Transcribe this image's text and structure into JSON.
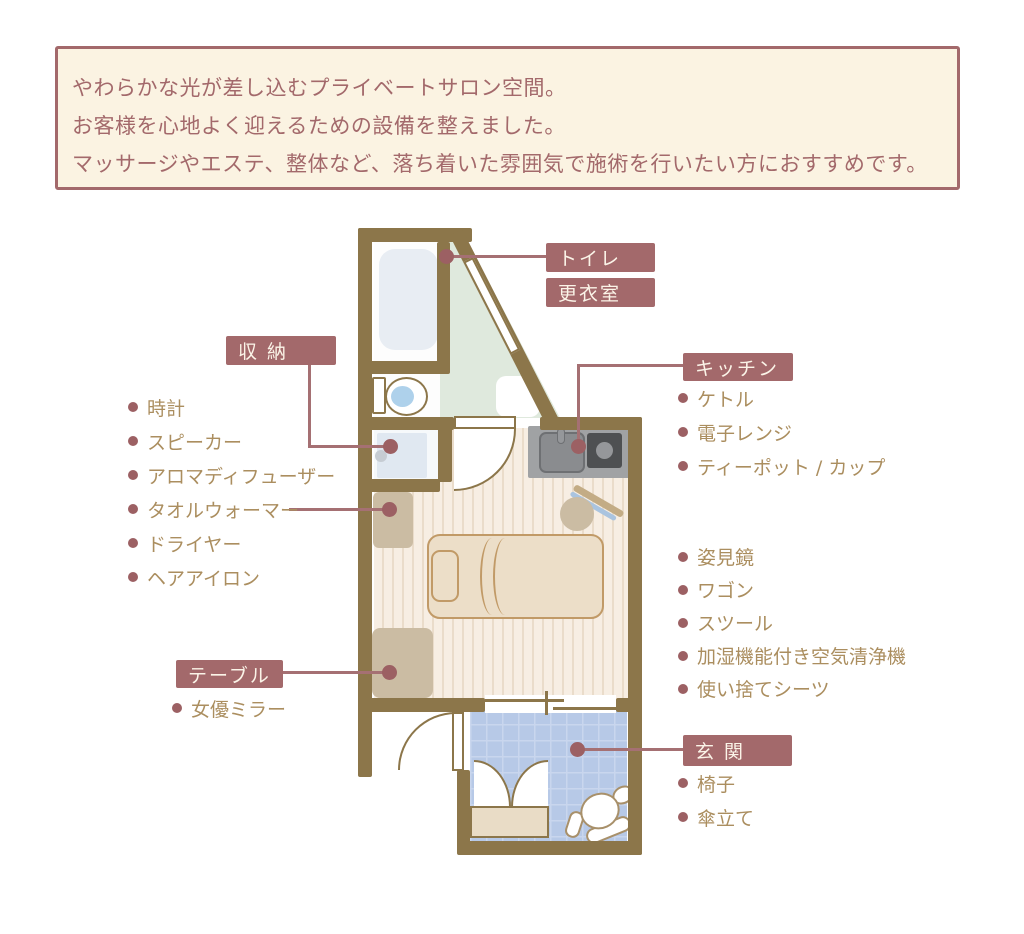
{
  "header": {
    "lines": [
      "やわらかな光が差し込むプライベートサロン空間。",
      "お客様を心地よく迎えるための設備を整えました。",
      "マッサージやエステ、整体など、落ち着いた雰囲気で施術を行いたい方におすすめです。"
    ]
  },
  "labels": {
    "toilet": "トイレ",
    "changing_room": "更衣室",
    "storage": "収 納",
    "kitchen": "キッチン",
    "table": "テーブル",
    "entrance": "玄 関"
  },
  "lists": {
    "storage_items": [
      "時計",
      "スピーカー",
      "アロマディフューザー",
      "タオルウォーマー",
      "ドライヤー",
      "ヘアアイロン"
    ],
    "kitchen_items": [
      "ケトル",
      "電子レンジ",
      "ティーポット / カップ"
    ],
    "salon_items": [
      "姿見鏡",
      "ワゴン",
      "スツール",
      "加湿機能付き空気清浄機",
      "使い捨てシーツ"
    ],
    "table_items": [
      "女優ミラー"
    ],
    "entrance_items": [
      "椅子",
      "傘立て"
    ]
  },
  "colors": {
    "accent_rose": "#a3696b",
    "wall_brown": "#8c764a",
    "list_text": "#ab8e5f",
    "mint_floor": "#dfe9dd",
    "entrance_tile": "#b7c9e7",
    "wood_floor": "#f7eee3",
    "tan_furniture": "#cbbca3",
    "bed_beige": "#ecdec8"
  }
}
